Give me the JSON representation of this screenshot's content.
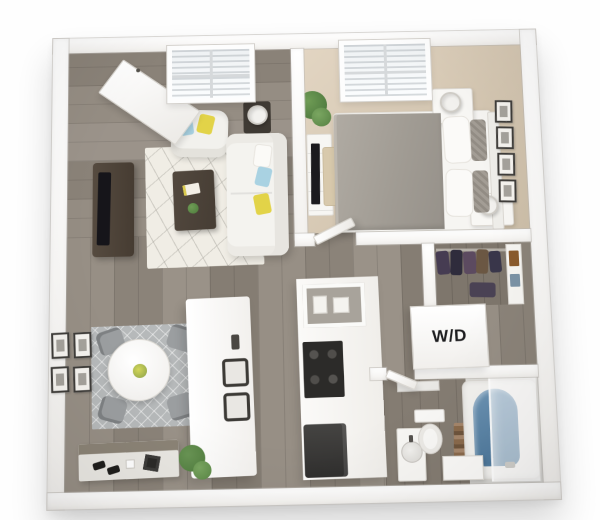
{
  "scene": {
    "type": "3d-floorplan-one-bedroom-apartment",
    "labels": {
      "washer_dryer": "W/D"
    },
    "colors": {
      "background": "#ffffff",
      "walls": "#f7f5f2",
      "wood_floor": "#90887d",
      "bedroom_carpet": "#d8cbb8",
      "closet_floor": "#7e766c",
      "living_rug": "#f0ede5",
      "dining_rug": "#b6b9ba",
      "sofa_white": "#f4f3ef",
      "pillow_yellow": "#e2d348",
      "pillow_blue": "#a9d2e2",
      "bed_duvet": "#a19c94",
      "dark_wood_furniture": "#4e4339",
      "appliance_dark": "#2c2b29",
      "tub_water": "#4a7599",
      "plant_green": "#568143",
      "wd_text": "#1d1d1f"
    }
  }
}
